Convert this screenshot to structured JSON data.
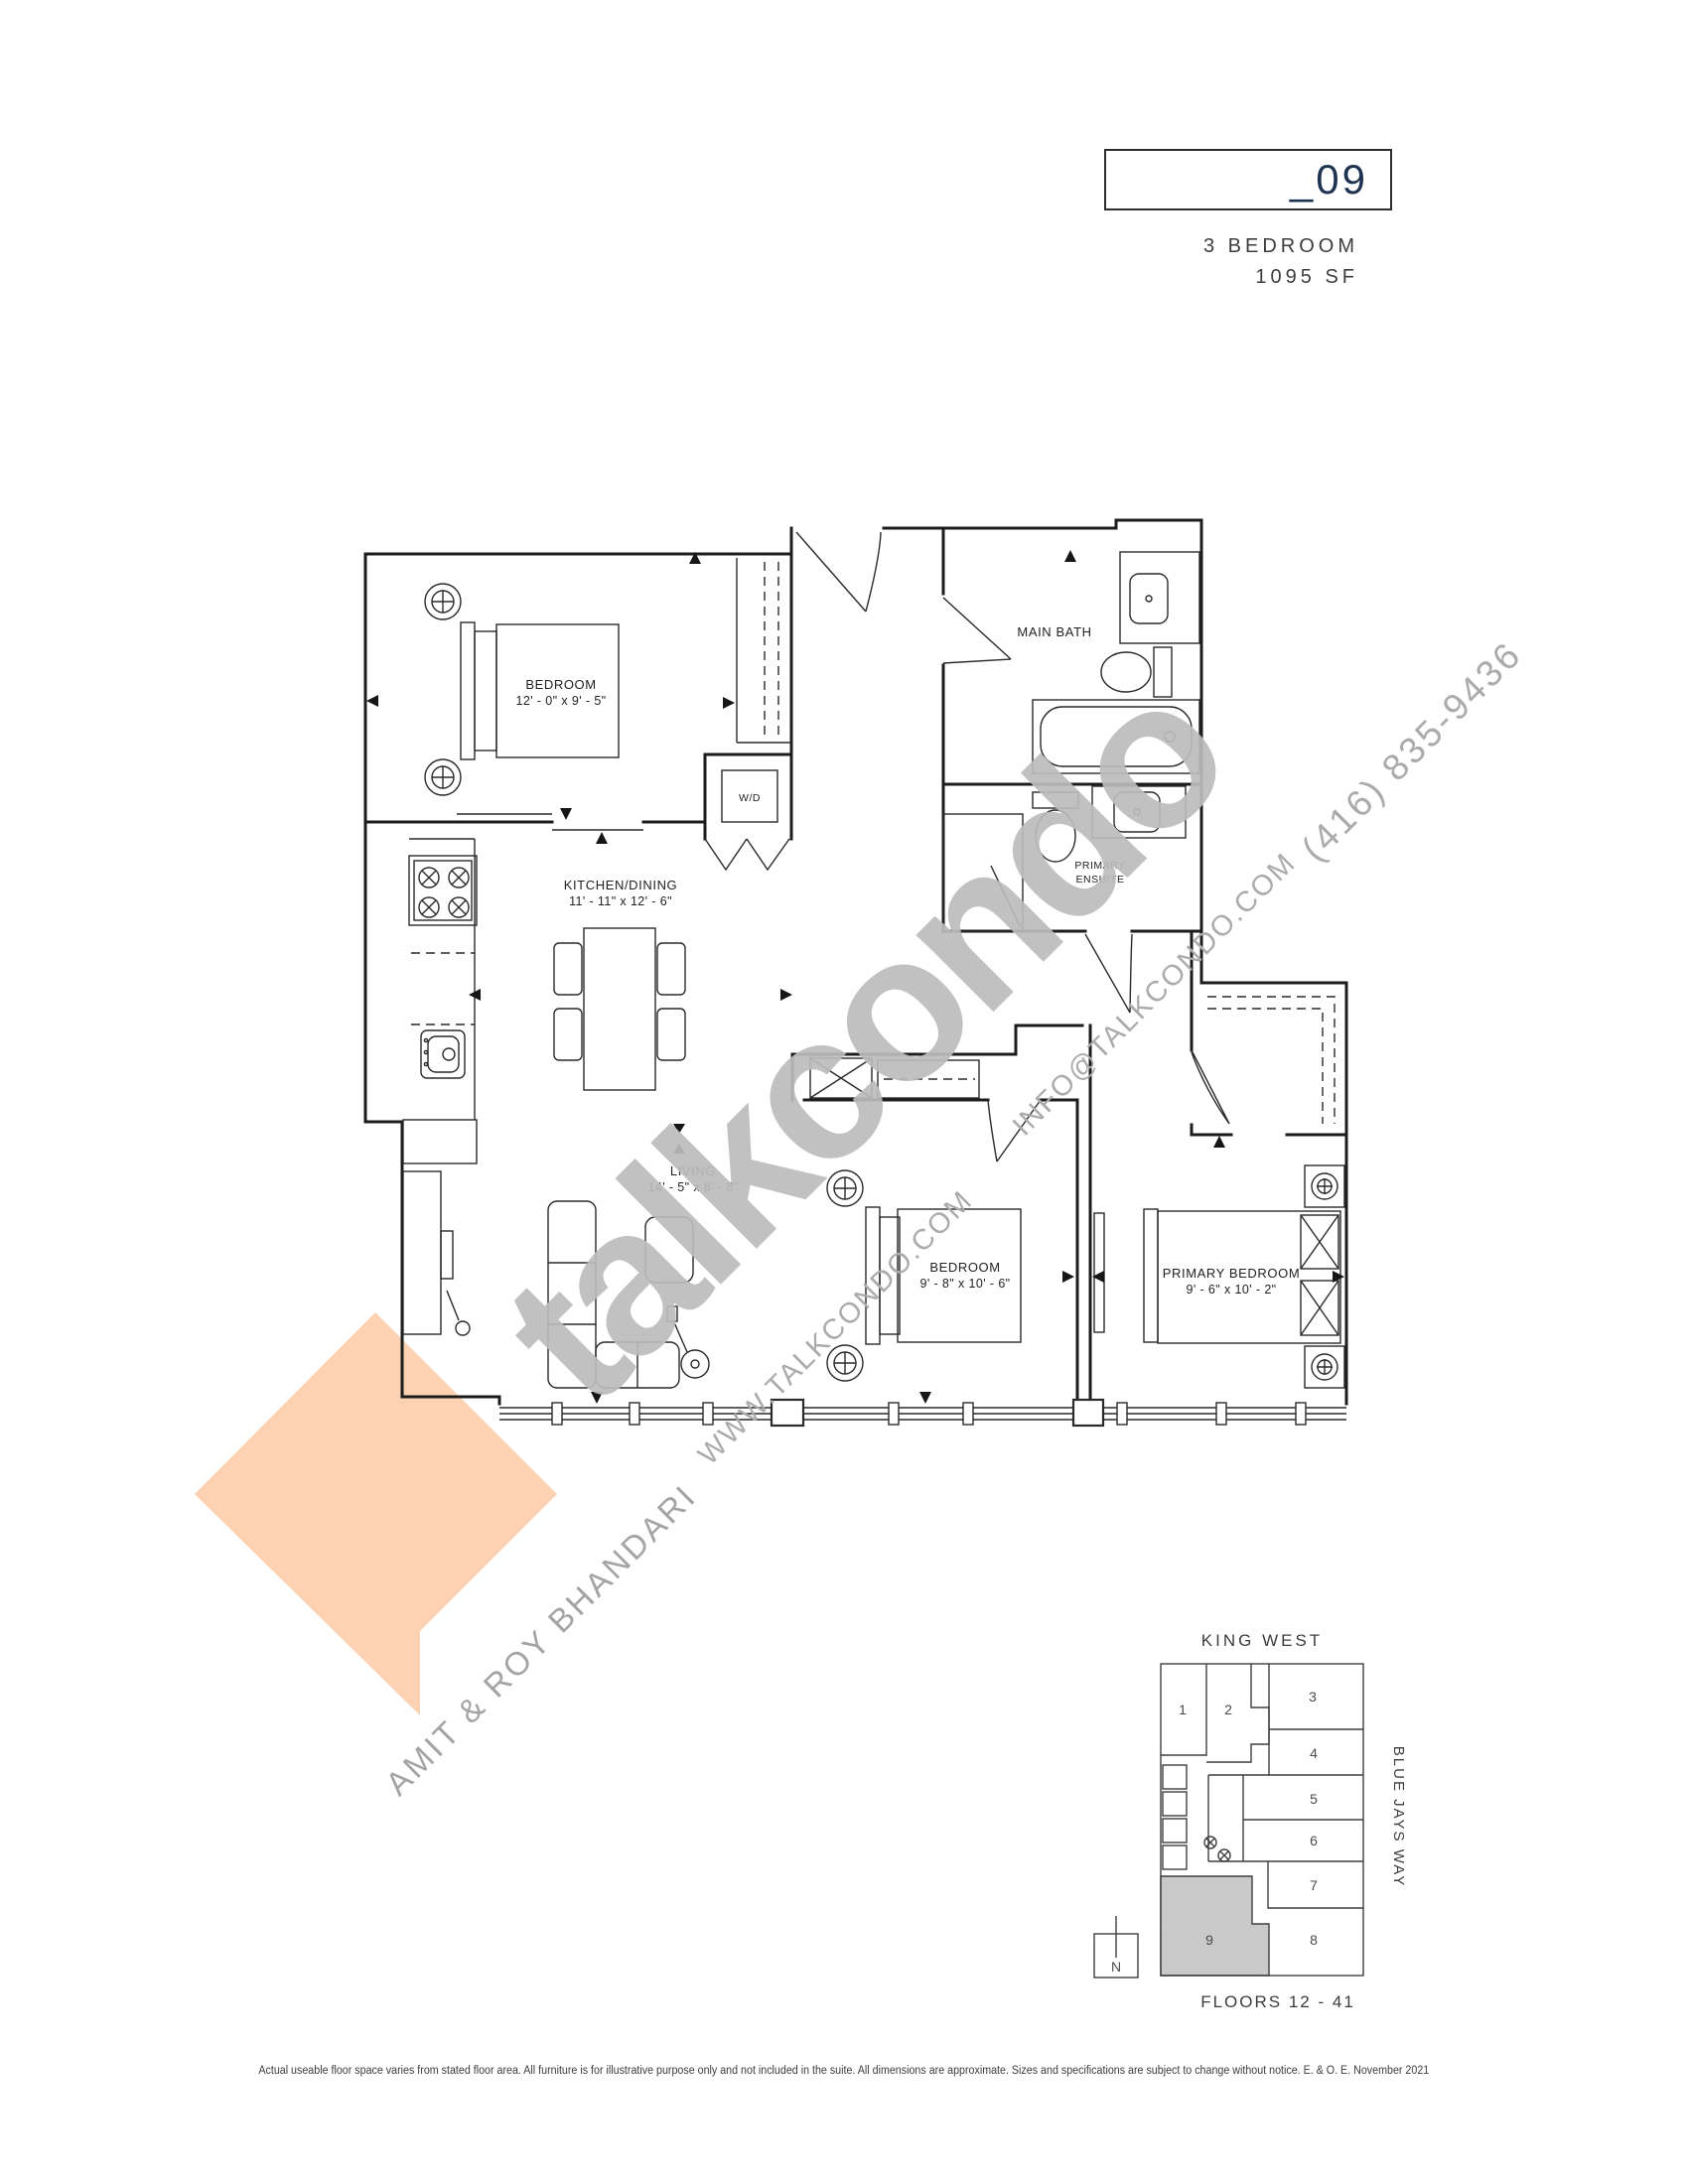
{
  "header": {
    "unit_number": "_09",
    "unit_type": "3 BEDROOM",
    "unit_area": "1095 SF"
  },
  "rooms": {
    "bedroom_top": {
      "name": "BEDROOM",
      "dims": "12' - 0\" x 9' - 5\""
    },
    "main_bath": {
      "name": "MAIN BATH"
    },
    "laundry": {
      "name": "W/D"
    },
    "kitchen_dining": {
      "name": "KITCHEN/DINING",
      "dims": "11' - 11\" x 12' - 6\""
    },
    "primary_ensuite": {
      "line1": "PRIMARY",
      "line2": "ENSUITE"
    },
    "living": {
      "name": "LIVING",
      "dims": "14' - 5\" x 8' - 8\""
    },
    "bedroom_middle": {
      "name": "BEDROOM",
      "dims": "9' - 8\" x 10' - 6\""
    },
    "primary_bedroom": {
      "name": "PRIMARY BEDROOM",
      "dims": "9' - 6\" x 10' - 2\""
    }
  },
  "watermarks": {
    "brand": "talkcondo",
    "phone": "(416) 835-9436",
    "email": "INFO@TALKCONDO.COM",
    "website": "WWW.TALKCONDO.COM",
    "agents": "AMIT & ROY BHANDARI"
  },
  "keyplan": {
    "street_top": "KING WEST",
    "street_right": "BLUE JAYS WAY",
    "floors_label": "FLOORS 12 - 41",
    "north_label": "N",
    "highlighted_unit": "9",
    "units": [
      "1",
      "2",
      "3",
      "4",
      "5",
      "6",
      "7",
      "8",
      "9"
    ]
  },
  "footer": {
    "disclaimer": "Actual useable floor space varies from stated floor area. All furniture is for illustrative purpose only and not included in the suite. All dimensions are approximate. Sizes and specifications are subject to change without notice. E. & O. E. November 2021"
  },
  "colors": {
    "title_navy": "#1e3352",
    "text_dark": "#3d3d3d",
    "watermark_gray": "#bcbcbc",
    "diamond_peach": "#fcd2b2",
    "plan_line": "#1c1c1c",
    "keyplan_highlight": "#c9c9c9"
  }
}
